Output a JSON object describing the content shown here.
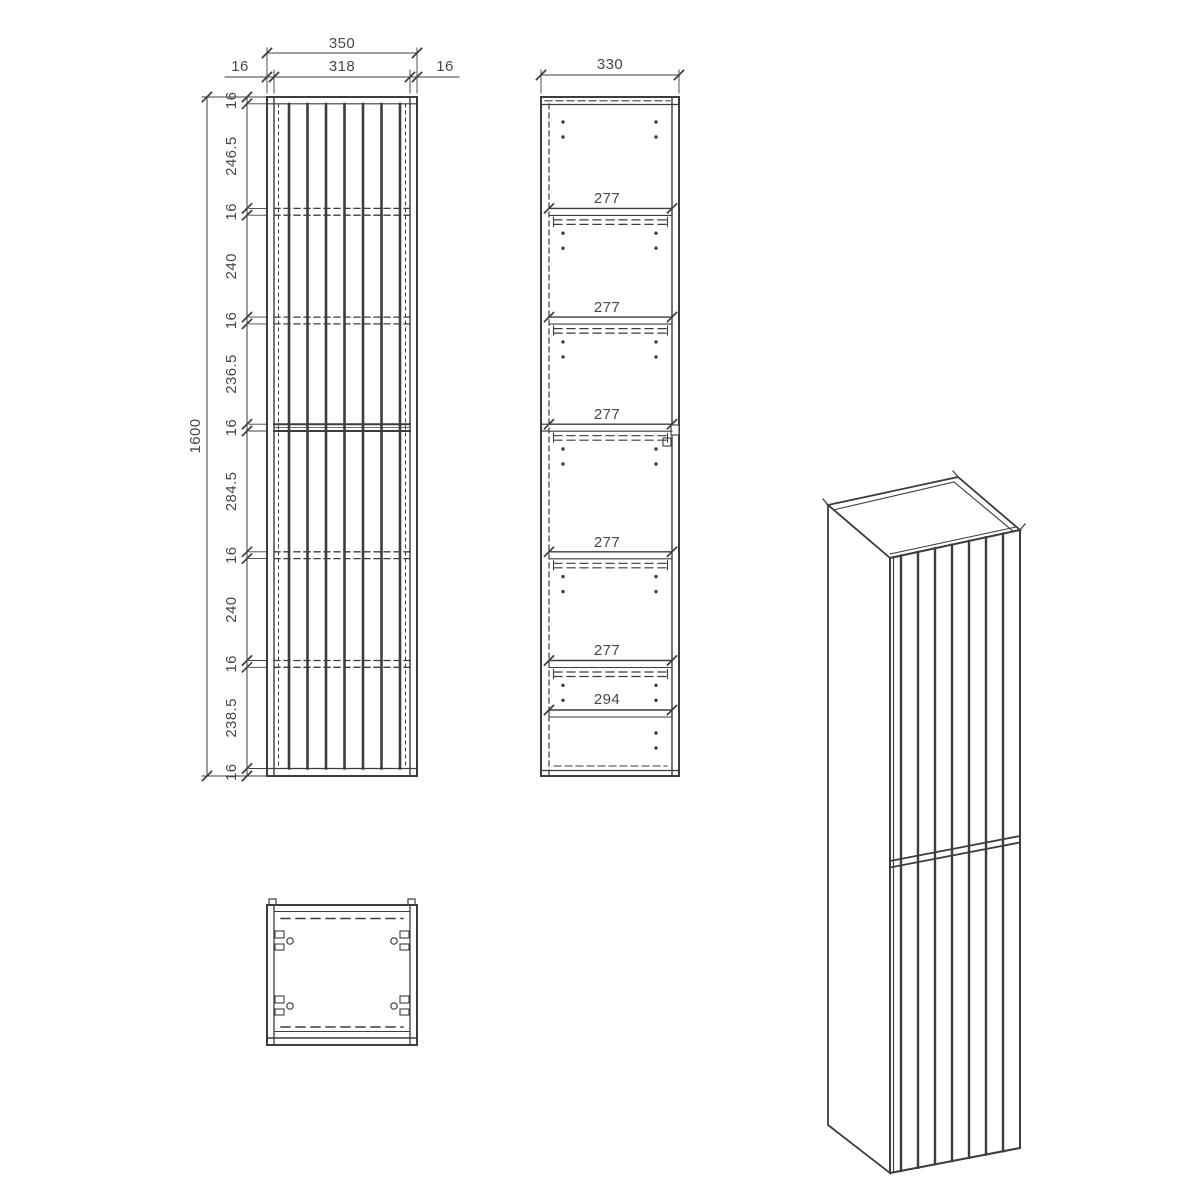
{
  "drawing": {
    "kind": "furniture technical drawing - tall wall cabinet",
    "front_view": {
      "dim_total_width": "350",
      "dim_inner_width": "318",
      "dim_side_left": "16",
      "dim_side_right": "16",
      "dim_total_height": "1600",
      "height_chain": [
        "16",
        "246.5",
        "16",
        "240",
        "16",
        "236.5",
        "16",
        "284.5",
        "16",
        "240",
        "16",
        "238.5",
        "16"
      ]
    },
    "side_view": {
      "dim_total_depth": "330",
      "shelf_depths": [
        "277",
        "277",
        "277",
        "277",
        "277"
      ],
      "dim_bottom_depth": "294"
    },
    "colors": {
      "line": "#3d3d3d",
      "text": "#474747",
      "background": "#ffffff"
    }
  }
}
